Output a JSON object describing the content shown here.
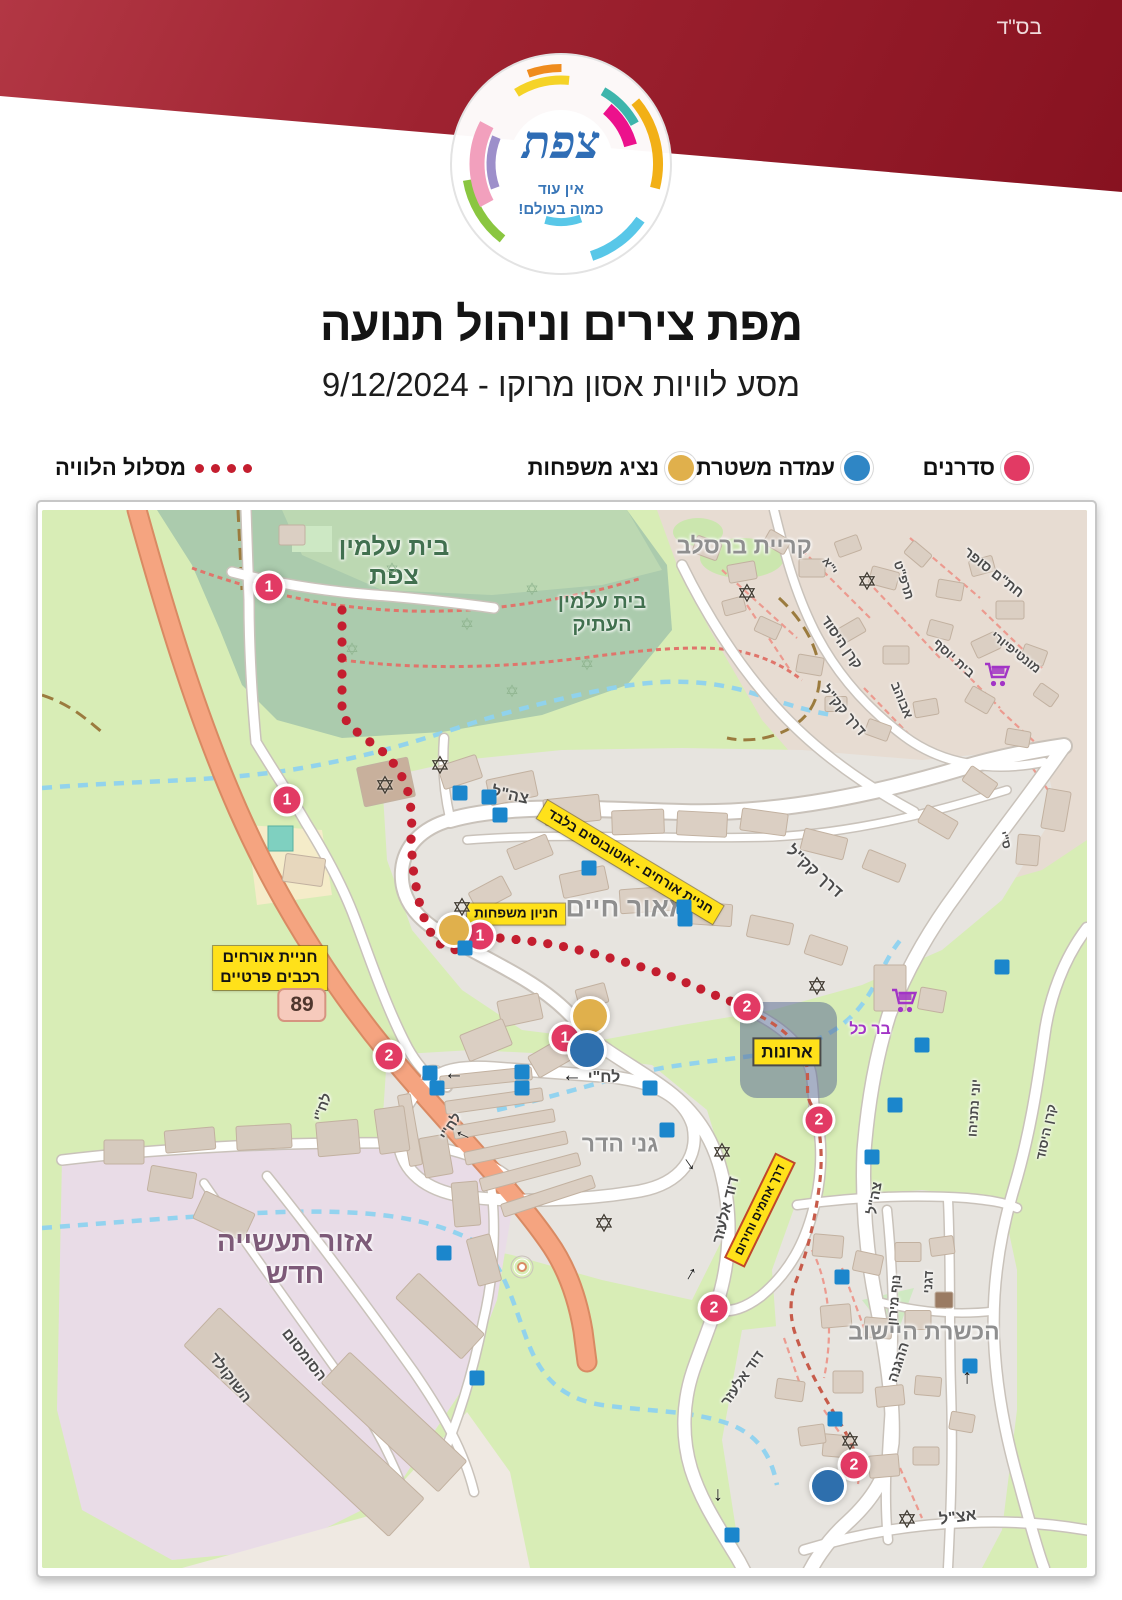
{
  "meta": {
    "bsd": "בס\"ד"
  },
  "logo": {
    "city_name": "צפת",
    "tagline_line1": "אין עוד",
    "tagline_line2": "כמוה בעולם!"
  },
  "header": {
    "title": "מפת צירים וניהול תנועה",
    "subtitle": "מסע לוויות אסון מרוקו - 9/12/2024"
  },
  "legend": {
    "items": [
      {
        "id": "sadranim",
        "label": "סדרנים",
        "color": "#e23a64"
      },
      {
        "id": "police-post",
        "label": "עמדה משטרתית",
        "color": "#2f86c5"
      },
      {
        "id": "family-rep",
        "label": "נציג משפחות",
        "color": "#e0b04c"
      },
      {
        "id": "route",
        "label": "מסלול הלוויה",
        "color": "#c41e2f"
      }
    ]
  },
  "colors": {
    "route_dot": "#c41e2f",
    "marker_pink": "#e23a64",
    "marker_gold": "#e0b04c",
    "marker_blue": "#2e6fad",
    "police_square": "#1b86cc"
  },
  "map": {
    "icons": {
      "star_glyph": "✡",
      "arrow_glyph": "→"
    },
    "area_labels": [
      {
        "text": "בית עלמין\nצפת",
        "x": 352,
        "y": 52,
        "rot": 0,
        "fs": 25,
        "cls": "cem"
      },
      {
        "text": "בית עלמין\nהעתיק",
        "x": 560,
        "y": 104,
        "rot": 0,
        "fs": 20,
        "cls": "cem"
      },
      {
        "text": "קריית ברסלב",
        "x": 702,
        "y": 36,
        "rot": 0,
        "fs": 23,
        "cls": "area"
      },
      {
        "text": "מאור חיים",
        "x": 585,
        "y": 398,
        "rot": 0,
        "fs": 27,
        "cls": "area"
      },
      {
        "text": "גני הדר",
        "x": 578,
        "y": 634,
        "rot": 0,
        "fs": 23,
        "cls": "area"
      },
      {
        "text": "הכשרת היישוב",
        "x": 882,
        "y": 822,
        "rot": 0,
        "fs": 23,
        "cls": "area"
      },
      {
        "text": "אזור תעשייה\nחדש",
        "x": 253,
        "y": 748,
        "rot": 0,
        "fs": 28,
        "cls": "industrial"
      },
      {
        "text": "בר כל",
        "x": 828,
        "y": 520,
        "rot": 0,
        "fs": 16,
        "cls": "poi"
      }
    ],
    "street_labels": [
      {
        "text": "צה\"ל",
        "x": 468,
        "y": 286,
        "rot": 12,
        "fs": 16
      },
      {
        "text": "דרך קק\"ל",
        "x": 772,
        "y": 362,
        "rot": 42,
        "fs": 16
      },
      {
        "text": "לח\"י",
        "x": 562,
        "y": 568,
        "rot": 0,
        "fs": 16
      },
      {
        "text": "לח\"י",
        "x": 408,
        "y": 616,
        "rot": -58,
        "fs": 14
      },
      {
        "text": "לח\"י",
        "x": 280,
        "y": 597,
        "rot": -70,
        "fs": 14
      },
      {
        "text": "דוד אלעזר",
        "x": 684,
        "y": 700,
        "rot": -76,
        "fs": 15
      },
      {
        "text": "דוד אלעזר",
        "x": 700,
        "y": 868,
        "rot": -55,
        "fs": 14
      },
      {
        "text": "הסומסום",
        "x": 262,
        "y": 845,
        "rot": 52,
        "fs": 15
      },
      {
        "text": "השוקולד",
        "x": 188,
        "y": 868,
        "rot": 52,
        "fs": 15
      },
      {
        "text": "ההגנה",
        "x": 856,
        "y": 852,
        "rot": -72,
        "fs": 14
      },
      {
        "text": "נוף מירון",
        "x": 852,
        "y": 790,
        "rot": -85,
        "fs": 13
      },
      {
        "text": "דגני",
        "x": 886,
        "y": 772,
        "rot": -87,
        "fs": 13
      },
      {
        "text": "אצ\"ל",
        "x": 916,
        "y": 1008,
        "rot": -8,
        "fs": 16
      },
      {
        "text": "צה\"ל",
        "x": 832,
        "y": 688,
        "rot": -80,
        "fs": 14
      },
      {
        "text": "יוני נתניהו",
        "x": 932,
        "y": 598,
        "rot": -86,
        "fs": 13
      },
      {
        "text": "קרן היסוד",
        "x": 1004,
        "y": 622,
        "rot": -78,
        "fs": 13
      },
      {
        "text": "חת\"ם סופר",
        "x": 952,
        "y": 62,
        "rot": 38,
        "fs": 14
      },
      {
        "text": "תרפ\"ט",
        "x": 862,
        "y": 70,
        "rot": 72,
        "fs": 13
      },
      {
        "text": "י\"א",
        "x": 788,
        "y": 56,
        "rot": 55,
        "fs": 12
      },
      {
        "text": "קרן היסוד",
        "x": 800,
        "y": 132,
        "rot": 55,
        "fs": 14
      },
      {
        "text": "דרך קק\"ל",
        "x": 802,
        "y": 200,
        "rot": 50,
        "fs": 14
      },
      {
        "text": "בית יוסף",
        "x": 912,
        "y": 148,
        "rot": 42,
        "fs": 13
      },
      {
        "text": "אבוהב",
        "x": 860,
        "y": 190,
        "rot": 68,
        "fs": 13
      },
      {
        "text": "מונטיפיורי",
        "x": 974,
        "y": 142,
        "rot": 38,
        "fs": 13
      },
      {
        "text": "ס\"י",
        "x": 963,
        "y": 330,
        "rot": 72,
        "fs": 12
      }
    ],
    "yellow_labels": [
      {
        "text": "חניית אורחים - אוטובוסים בלבד",
        "x": 588,
        "y": 352,
        "rot": 31,
        "fs": 13.5
      },
      {
        "text": "חניון משפחות",
        "x": 474,
        "y": 404,
        "rot": 0,
        "fs": 13.5
      },
      {
        "text": "חניית אורחים\nרכבים פרטיים",
        "x": 228,
        "y": 458,
        "rot": 0,
        "fs": 16
      },
      {
        "text": "ארונות",
        "x": 745,
        "y": 542,
        "rot": 0,
        "fs": 17,
        "border": "dark"
      },
      {
        "text": "דרך אחמים וחירום",
        "x": 718,
        "y": 700,
        "rot": -64,
        "fs": 12,
        "border": "red"
      }
    ],
    "road_shield": {
      "text": "89",
      "x": 260,
      "y": 495
    },
    "markers": {
      "pink": [
        {
          "n": "1",
          "x": 227,
          "y": 77
        },
        {
          "n": "1",
          "x": 245,
          "y": 290
        },
        {
          "n": "1",
          "x": 438,
          "y": 426
        },
        {
          "n": "1",
          "x": 523,
          "y": 528
        },
        {
          "n": "2",
          "x": 347,
          "y": 546
        },
        {
          "n": "2",
          "x": 705,
          "y": 497
        },
        {
          "n": "2",
          "x": 777,
          "y": 610
        },
        {
          "n": "2",
          "x": 672,
          "y": 798
        },
        {
          "n": "2",
          "x": 812,
          "y": 955
        }
      ],
      "gold": [
        {
          "x": 412,
          "y": 420,
          "r": 15
        },
        {
          "x": 548,
          "y": 506,
          "r": 17
        }
      ],
      "blue": [
        {
          "x": 545,
          "y": 540,
          "r": 17
        },
        {
          "x": 786,
          "y": 976,
          "r": 16
        }
      ],
      "police_squares": [
        [
          418,
          283
        ],
        [
          447,
          287
        ],
        [
          458,
          305
        ],
        [
          547,
          358
        ],
        [
          642,
          397
        ],
        [
          643,
          409
        ],
        [
          423,
          438
        ],
        [
          960,
          457
        ],
        [
          880,
          535
        ],
        [
          388,
          563
        ],
        [
          395,
          578
        ],
        [
          480,
          562
        ],
        [
          480,
          578
        ],
        [
          608,
          578
        ],
        [
          625,
          620
        ],
        [
          853,
          595
        ],
        [
          830,
          647
        ],
        [
          402,
          743
        ],
        [
          800,
          767
        ],
        [
          435,
          868
        ],
        [
          928,
          856
        ],
        [
          793,
          909
        ],
        [
          690,
          1025
        ]
      ]
    },
    "stars": [
      [
        398,
        256
      ],
      [
        343,
        276
      ],
      [
        705,
        84
      ],
      [
        825,
        72
      ],
      [
        420,
        398
      ],
      [
        775,
        477
      ],
      [
        680,
        643
      ],
      [
        562,
        714
      ],
      [
        808,
        932
      ],
      [
        865,
        1010
      ]
    ],
    "faint_stars": [
      [
        350,
        60
      ],
      [
        425,
        115
      ],
      [
        490,
        80
      ],
      [
        545,
        155
      ],
      [
        310,
        140
      ],
      [
        470,
        182
      ]
    ],
    "carts": [
      [
        955,
        167
      ],
      [
        862,
        493
      ]
    ],
    "arrows": [
      {
        "x": 530,
        "y": 570,
        "rot": 180
      },
      {
        "x": 412,
        "y": 568,
        "rot": 180
      },
      {
        "x": 420,
        "y": 627,
        "rot": 205
      },
      {
        "x": 649,
        "y": 653,
        "rot": 55
      },
      {
        "x": 647,
        "y": 763,
        "rot": -60
      },
      {
        "x": 923,
        "y": 868,
        "rot": -90
      },
      {
        "x": 678,
        "y": 985,
        "rot": 90
      }
    ],
    "route_points": [
      [
        300,
        100
      ],
      [
        300,
        205
      ],
      [
        310,
        218
      ],
      [
        328,
        232
      ],
      [
        345,
        245
      ],
      [
        358,
        262
      ],
      [
        366,
        282
      ],
      [
        370,
        305
      ],
      [
        369,
        330
      ],
      [
        371,
        358
      ],
      [
        376,
        388
      ],
      [
        384,
        414
      ],
      [
        394,
        432
      ],
      [
        412,
        440
      ],
      [
        432,
        432
      ],
      [
        440,
        427
      ],
      [
        458,
        428
      ],
      [
        480,
        430
      ],
      [
        502,
        433
      ],
      [
        524,
        437
      ],
      [
        546,
        442
      ],
      [
        568,
        448
      ],
      [
        590,
        454
      ],
      [
        612,
        461
      ],
      [
        633,
        468
      ],
      [
        652,
        476
      ],
      [
        670,
        484
      ],
      [
        688,
        491
      ],
      [
        702,
        496
      ]
    ]
  }
}
